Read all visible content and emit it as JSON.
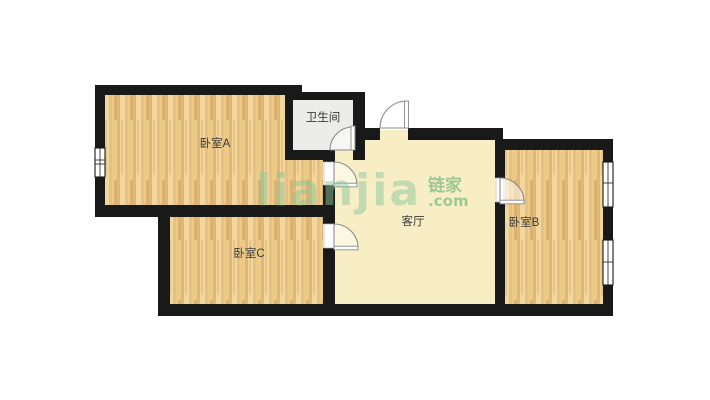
{
  "floorplan": {
    "rooms": [
      {
        "id": "bedroom-a",
        "label": "卧室A"
      },
      {
        "id": "bathroom",
        "label": "卫生间"
      },
      {
        "id": "living-room",
        "label": "客厅"
      },
      {
        "id": "bedroom-b",
        "label": "卧室B"
      },
      {
        "id": "bedroom-c",
        "label": "卧室C"
      }
    ],
    "colors": {
      "wall": "#191919",
      "wood_floor_light": "#f1d69e",
      "wood_floor_dark": "#e0b873",
      "living_room_floor": "#f7eec6",
      "bathroom_floor": "#ececea",
      "room_label": "#3a3a3a",
      "door_stroke": "#8a8a8a",
      "watermark_green": "#7cc08d"
    }
  },
  "watermark": {
    "brand": "lianjia",
    "cn": "链家",
    "domain": ".com"
  }
}
